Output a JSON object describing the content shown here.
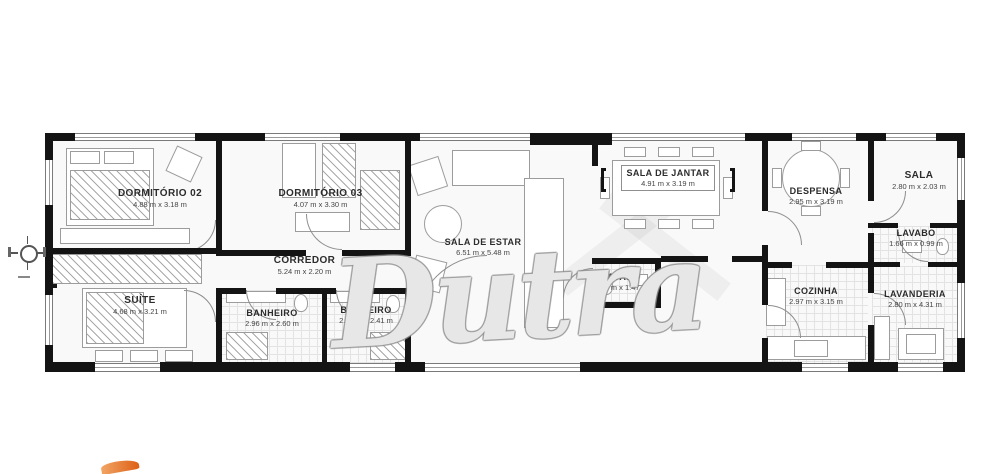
{
  "plan": {
    "watermark": "Dutra",
    "rooms": [
      {
        "id": "dormitorio-02",
        "name": "DORMITÓRIO 02",
        "dims": "4.88 m x 3.18 m"
      },
      {
        "id": "dormitorio-03",
        "name": "DORMITÓRIO 03",
        "dims": "4.07 m x 3.30 m"
      },
      {
        "id": "suite",
        "name": "SUÍTE",
        "dims": "4.68 m x 3.21 m"
      },
      {
        "id": "corredor",
        "name": "CORREDOR",
        "dims": "5.24 m x 2.20 m"
      },
      {
        "id": "banheiro-1",
        "name": "BANHEIRO",
        "dims": "2.96 m x 2.60 m"
      },
      {
        "id": "banheiro-2",
        "name": "BANHEIRO",
        "dims": "2.16 m x 2.41 m"
      },
      {
        "id": "sala-de-estar",
        "name": "SALA DE ESTAR",
        "dims": "6.51 m x 5.48 m"
      },
      {
        "id": "sala-de-jantar",
        "name": "SALA DE JANTAR",
        "dims": "4.91 m x 3.19 m"
      },
      {
        "id": "lavabo-1",
        "name": "LAVABO",
        "dims": "1.94 m x 1.47 m"
      },
      {
        "id": "despensa",
        "name": "DESPENSA",
        "dims": "2.95 m x 3.19 m"
      },
      {
        "id": "sala",
        "name": "SALA",
        "dims": "2.80 m x 2.03 m"
      },
      {
        "id": "lavabo-2",
        "name": "LAVABO",
        "dims": "1.66 m x 0.99 m"
      },
      {
        "id": "cozinha",
        "name": "COZINHA",
        "dims": "2.97 m x 3.15 m"
      },
      {
        "id": "lavanderia",
        "name": "LAVANDERIA",
        "dims": "2.80 m x 4.31 m"
      }
    ],
    "colors": {
      "wall": "#141414",
      "accent_logo": "#dd5f14",
      "watermark_outline": "#919191"
    }
  }
}
